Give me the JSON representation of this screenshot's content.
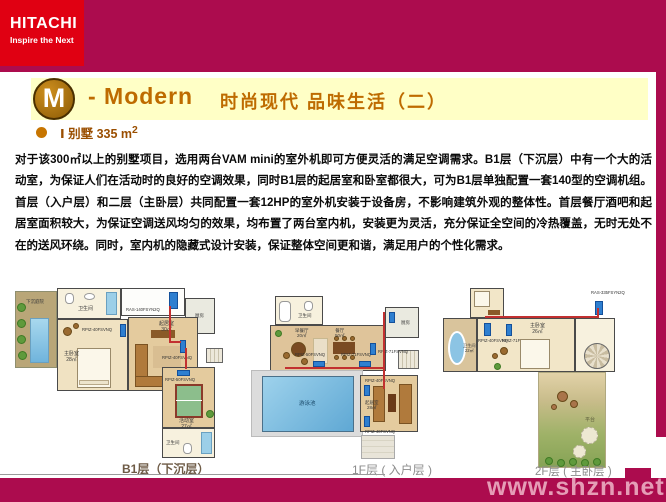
{
  "logo": {
    "brand": "HITACHI",
    "tagline": "Inspire the Next"
  },
  "title": {
    "badge": "M",
    "en": "- Modern",
    "zh": "时尚现代 品味生活（二）"
  },
  "subtitle": {
    "label": "Ⅰ 别墅  335 m",
    "sup": "2"
  },
  "body": {
    "paragraph": "对于该300㎡以上的别墅项目，选用两台VAM mini的室外机即可方便灵活的满足空调需求。B1层（下沉层）中有一个大的活动室，为保证人们在活动时的良好的空调效果，同时B1层的起居室和卧室都很大，可为B1层单独配置一套140型的空调机组。首层（入户层）和二层（主卧层）共同配置一套12HP的室外机安装于设备房，不影响建筑外观的整体性。首层餐厅酒吧和起居室面积较大，为保证空调送风均匀的效果，均布置了两台室内机，安装更为灵活，充分保证全空间的冷热覆盖，无时无处不在的送风环绕。同时，室内机的隐藏式设计安装，保证整体空间更和谐，满足用户的个性化需求。"
  },
  "plans": {
    "b1": {
      "caption": "B1层（下沉层）",
      "garden": "下沉庭院",
      "bath_top": "卫生间",
      "kitchen": "厨房",
      "outdoor_unit": "RAS-140FSYN2Q",
      "master": "主卧室",
      "master_area": "28㎡",
      "living": "起居室",
      "living_area": "30㎡",
      "activity": "活动室",
      "activity_area": "27㎡",
      "bath_bottom": "卫生间",
      "unit_a": "RPIZ-40FSVNQ",
      "unit_b": "RPIZ-40FSVNQ",
      "unit_c": "RPIZ-50FSVNQ"
    },
    "f1": {
      "caption": "1F层 ( 入户层 )",
      "bath": "卫生间",
      "breakfast": "早餐厅",
      "breakfast_area": "20㎡",
      "dining": "餐厅",
      "dining_area": "50㎡",
      "kitchen": "厨房",
      "pool": "游泳池",
      "living": "起居室",
      "living_area": "28㎡",
      "unit_a": "RPIZ-50FSVNQ",
      "unit_b": "RPIZ-71FSVNQ",
      "unit_c": "RPIZ-71FSVNQ",
      "unit_d": "RPIZ-40FSVNQ",
      "unit_e": "RPIZ-40FSVNQ"
    },
    "f2": {
      "caption": "2F层 ( 主卧层 )",
      "bath": "卫生间",
      "bath_area": "22㎡",
      "master": "主卧室",
      "master_area": "26㎡",
      "terrace": "平台",
      "outdoor_unit": "RAS-335FSYN2Q",
      "unit_a": "RPIZ-40FSVNQ",
      "unit_b": "RPIZ-71FSVNQ"
    }
  },
  "footer": {
    "watermark": "www.shzn.net"
  },
  "colors": {
    "crimson": "#AC0C4E",
    "hitachi_red": "#E00012",
    "band_yellow": "#FFFFC6",
    "title_orange": "#BE6B00"
  }
}
